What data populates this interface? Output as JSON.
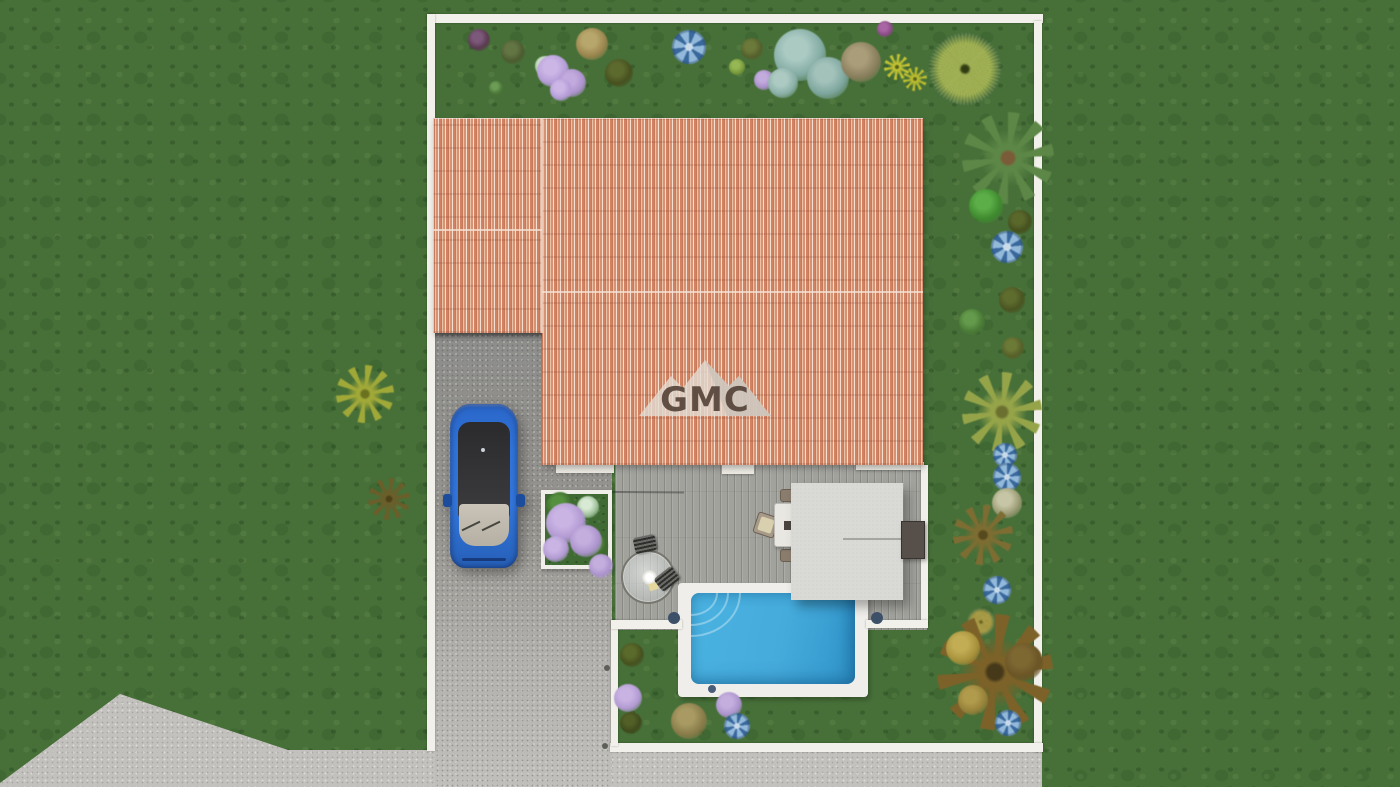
{
  "scene": {
    "description": "3D top-down site plan rendering of a villa plot",
    "watermark": {
      "text": "GMC"
    }
  },
  "palette": {
    "grass": "#477039",
    "street_concrete": "#c3c1bd",
    "driveway": "#96948f",
    "deck_wood": "#a2a29d",
    "roof_tile": "#dba183",
    "pool_water": "#45abdb",
    "pool_coping": "#efeeea",
    "boundary_wall": "#f2f0ea",
    "pergola": "#d9d9d5",
    "car_blue": "#2f74da"
  },
  "plants": [
    {
      "name": "bush-dark-purple",
      "type": "bush",
      "x": 479,
      "y": 40,
      "r": 11,
      "c1": "#5a3a50",
      "c2": "#7c587a"
    },
    {
      "name": "bush-olive",
      "type": "bush",
      "x": 513,
      "y": 52,
      "r": 12,
      "c1": "#4c5c30",
      "c2": "#647544"
    },
    {
      "name": "bush-green-small",
      "type": "bush",
      "x": 496,
      "y": 88,
      "r": 7,
      "c1": "#4e7a3a",
      "c2": "#6c9c56"
    },
    {
      "name": "plant-white-green",
      "type": "bush",
      "x": 545,
      "y": 66,
      "r": 10,
      "c1": "#9ec49a",
      "c2": "#d2e6ce"
    },
    {
      "name": "lilac-shrub",
      "type": "bush",
      "x": 553,
      "y": 71,
      "r": 16,
      "c1": "#b49cd6",
      "c2": "#cbb6e6"
    },
    {
      "name": "lilac-shrub",
      "type": "bush",
      "x": 572,
      "y": 83,
      "r": 14,
      "c1": "#ab92cc",
      "c2": "#c2aade"
    },
    {
      "name": "lilac-shrub",
      "type": "bush",
      "x": 561,
      "y": 90,
      "r": 11,
      "c1": "#b49cd6",
      "c2": "#cbb6e6"
    },
    {
      "name": "bush-tan",
      "type": "bush",
      "x": 592,
      "y": 44,
      "r": 16,
      "c1": "#9a854e",
      "c2": "#b8a76c"
    },
    {
      "name": "bush-dark-olive",
      "type": "bush",
      "x": 619,
      "y": 73,
      "r": 14,
      "c1": "#47501f",
      "c2": "#5d6a2e"
    },
    {
      "name": "blue-pinwheel-flower",
      "type": "pinwheel",
      "x": 689,
      "y": 47,
      "r": 17,
      "c1": "#39689c",
      "c2": "#93b9da"
    },
    {
      "name": "bush-yellow-green",
      "type": "bush",
      "x": 737,
      "y": 67,
      "r": 8,
      "c1": "#7a9a3a",
      "c2": "#95b754"
    },
    {
      "name": "bush-olive",
      "type": "bush",
      "x": 752,
      "y": 49,
      "r": 11,
      "c1": "#55602c",
      "c2": "#6b7a3a"
    },
    {
      "name": "lilac-small",
      "type": "bush",
      "x": 764,
      "y": 80,
      "r": 10,
      "c1": "#a98fc9",
      "c2": "#c2abdd"
    },
    {
      "name": "glaucous-shrub",
      "type": "bush",
      "x": 800,
      "y": 55,
      "r": 26,
      "c1": "#84aca4",
      "c2": "#aacac2"
    },
    {
      "name": "glaucous-shrub",
      "type": "bush",
      "x": 828,
      "y": 78,
      "r": 21,
      "c1": "#7ea69e",
      "c2": "#a2c2ba"
    },
    {
      "name": "glaucous-shrub",
      "type": "bush",
      "x": 783,
      "y": 83,
      "r": 15,
      "c1": "#8ab0a8",
      "c2": "#accac2"
    },
    {
      "name": "bush-magenta",
      "type": "bush",
      "x": 885,
      "y": 29,
      "r": 8,
      "c1": "#8a4a86",
      "c2": "#a867a4"
    },
    {
      "name": "bush-tan-gray",
      "type": "bush",
      "x": 861,
      "y": 62,
      "r": 20,
      "c1": "#8a7f5e",
      "c2": "#aa9e7a"
    },
    {
      "name": "yellow-daisy",
      "type": "palm",
      "x": 897,
      "y": 67,
      "r": 13,
      "c1": "#c2c232",
      "c2": "#55611c"
    },
    {
      "name": "yellow-daisy",
      "type": "palm",
      "x": 915,
      "y": 79,
      "r": 12,
      "c1": "#bcbc2e",
      "c2": "#55611c"
    },
    {
      "name": "round-tree-yellow-green",
      "type": "dandelion",
      "x": 965,
      "y": 69,
      "r": 36,
      "c1": "#9fb148",
      "c2": "#313c12"
    },
    {
      "name": "palm-tree-green",
      "type": "palm",
      "x": 1008,
      "y": 158,
      "r": 46,
      "c1": "#5d8747",
      "c2": "#7a5c38"
    },
    {
      "name": "bush-bright-green",
      "type": "bush",
      "x": 986,
      "y": 206,
      "r": 17,
      "c1": "#3f8a2f",
      "c2": "#5cae48"
    },
    {
      "name": "bush-dark-olive",
      "type": "bush",
      "x": 1020,
      "y": 222,
      "r": 12,
      "c1": "#45501e",
      "c2": "#5a682c"
    },
    {
      "name": "blue-pinwheel-flower",
      "type": "pinwheel",
      "x": 1007,
      "y": 247,
      "r": 16,
      "c1": "#39689c",
      "c2": "#93b9da"
    },
    {
      "name": "bush-dark-olive",
      "type": "bush",
      "x": 1012,
      "y": 300,
      "r": 13,
      "c1": "#4a5422",
      "c2": "#5e6c2e"
    },
    {
      "name": "bush-green",
      "type": "bush",
      "x": 972,
      "y": 322,
      "r": 13,
      "c1": "#4a7a36",
      "c2": "#649a4c"
    },
    {
      "name": "bush-olive",
      "type": "bush",
      "x": 1013,
      "y": 348,
      "r": 11,
      "c1": "#566028",
      "c2": "#6c7a38"
    },
    {
      "name": "palm-tree-yellow",
      "type": "palm",
      "x": 1002,
      "y": 412,
      "r": 40,
      "c1": "#96a449",
      "c2": "#6b7030"
    },
    {
      "name": "blue-pinwheel-flower",
      "type": "pinwheel",
      "x": 1005,
      "y": 455,
      "r": 12,
      "c1": "#39689c",
      "c2": "#93b9da"
    },
    {
      "name": "blue-pinwheel-flower",
      "type": "pinwheel",
      "x": 1007,
      "y": 477,
      "r": 14,
      "c1": "#39689c",
      "c2": "#93b9da"
    },
    {
      "name": "plant-whitish",
      "type": "bush",
      "x": 1007,
      "y": 503,
      "r": 15,
      "c1": "#9a9a74",
      "c2": "#c6c6a6"
    },
    {
      "name": "fern-brown",
      "type": "palm",
      "x": 983,
      "y": 535,
      "r": 30,
      "c1": "#7d6d32",
      "c2": "#554a1e"
    },
    {
      "name": "blue-pinwheel-flower",
      "type": "pinwheel",
      "x": 997,
      "y": 590,
      "r": 14,
      "c1": "#39689c",
      "c2": "#93b9da"
    },
    {
      "name": "bush-yellow",
      "type": "dandelion",
      "x": 981,
      "y": 622,
      "r": 14,
      "c1": "#a89a3a",
      "c2": "#6b6020"
    },
    {
      "name": "autumn-palm-tree",
      "type": "palm",
      "x": 995,
      "y": 672,
      "r": 58,
      "c1": "#7c6228",
      "c2": "#46391a"
    },
    {
      "name": "autumn-highlight",
      "type": "bush",
      "x": 963,
      "y": 648,
      "r": 17,
      "c1": "#a8923c",
      "c2": "#c2ac54"
    },
    {
      "name": "autumn-highlight",
      "type": "bush",
      "x": 973,
      "y": 700,
      "r": 15,
      "c1": "#97823a",
      "c2": "#b09a4c"
    },
    {
      "name": "autumn-shadow",
      "type": "bush",
      "x": 1024,
      "y": 662,
      "r": 19,
      "c1": "#6b5526",
      "c2": "#7e6832"
    },
    {
      "name": "blue-pinwheel-flower",
      "type": "pinwheel",
      "x": 1008,
      "y": 723,
      "r": 13,
      "c1": "#39689c",
      "c2": "#93b9da"
    },
    {
      "name": "yucca-yellow",
      "type": "palm",
      "x": 365,
      "y": 394,
      "r": 29,
      "c1": "#a0a838",
      "c2": "#6a7220"
    },
    {
      "name": "fern-brown",
      "type": "palm",
      "x": 389,
      "y": 499,
      "r": 21,
      "c1": "#6b5e2a",
      "c2": "#4c4218"
    },
    {
      "name": "planter-foliage",
      "type": "bush",
      "x": 560,
      "y": 506,
      "r": 14,
      "c1": "#3e6a2e",
      "c2": "#55903f"
    },
    {
      "name": "planter-foliage",
      "type": "bush",
      "x": 596,
      "y": 546,
      "r": 12,
      "c1": "#3e6a2e",
      "c2": "#55903f"
    },
    {
      "name": "planter-succulent",
      "type": "bush",
      "x": 588,
      "y": 507,
      "r": 11,
      "c1": "#9ec09a",
      "c2": "#d8ead4"
    },
    {
      "name": "planter-lilac",
      "type": "bush",
      "x": 566,
      "y": 523,
      "r": 20,
      "c1": "#b29ad2",
      "c2": "#cab4e4"
    },
    {
      "name": "planter-lilac",
      "type": "bush",
      "x": 586,
      "y": 541,
      "r": 16,
      "c1": "#ab93cc",
      "c2": "#c4aede"
    },
    {
      "name": "planter-lilac",
      "type": "bush",
      "x": 556,
      "y": 549,
      "r": 13,
      "c1": "#b29ad2",
      "c2": "#cab4e4"
    },
    {
      "name": "planter-lilac",
      "type": "bush",
      "x": 601,
      "y": 566,
      "r": 12,
      "c1": "#ab93cc",
      "c2": "#c4aede"
    },
    {
      "name": "bush-dark-olive",
      "type": "bush",
      "x": 632,
      "y": 655,
      "r": 12,
      "c1": "#46511f",
      "c2": "#5a6a2a"
    },
    {
      "name": "lilac-shrub",
      "type": "bush",
      "x": 628,
      "y": 698,
      "r": 14,
      "c1": "#b29ad2",
      "c2": "#c9b3e3"
    },
    {
      "name": "bush-dark",
      "type": "bush",
      "x": 631,
      "y": 723,
      "r": 11,
      "c1": "#3f4a1c",
      "c2": "#525f26"
    },
    {
      "name": "bush-tan",
      "type": "bush",
      "x": 689,
      "y": 721,
      "r": 18,
      "c1": "#8a7c4a",
      "c2": "#a89a62"
    },
    {
      "name": "lilac-shrub",
      "type": "bush",
      "x": 729,
      "y": 705,
      "r": 13,
      "c1": "#ab93cc",
      "c2": "#c4aede"
    },
    {
      "name": "blue-pinwheel-flower",
      "type": "pinwheel",
      "x": 737,
      "y": 726,
      "r": 13,
      "c1": "#39689c",
      "c2": "#93b9da"
    },
    {
      "name": "navy-dot-plant",
      "type": "dot",
      "x": 712,
      "y": 689,
      "r": 4,
      "c1": "#4a5d78",
      "c2": "#4a5d78"
    },
    {
      "name": "navy-dot-plant",
      "type": "dot",
      "x": 674,
      "y": 618,
      "r": 6,
      "c1": "#3c5068",
      "c2": "#3c5068"
    },
    {
      "name": "navy-dot-plant",
      "type": "dot",
      "x": 877,
      "y": 618,
      "r": 6,
      "c1": "#3c5068",
      "c2": "#3c5068"
    },
    {
      "name": "drain-cap",
      "type": "dot",
      "x": 607,
      "y": 668,
      "r": 3,
      "c1": "#5f5f5a",
      "c2": "#5f5f5a"
    },
    {
      "name": "drain-cap",
      "type": "dot",
      "x": 605,
      "y": 746,
      "r": 3,
      "c1": "#5f5f5a",
      "c2": "#5f5f5a"
    }
  ]
}
